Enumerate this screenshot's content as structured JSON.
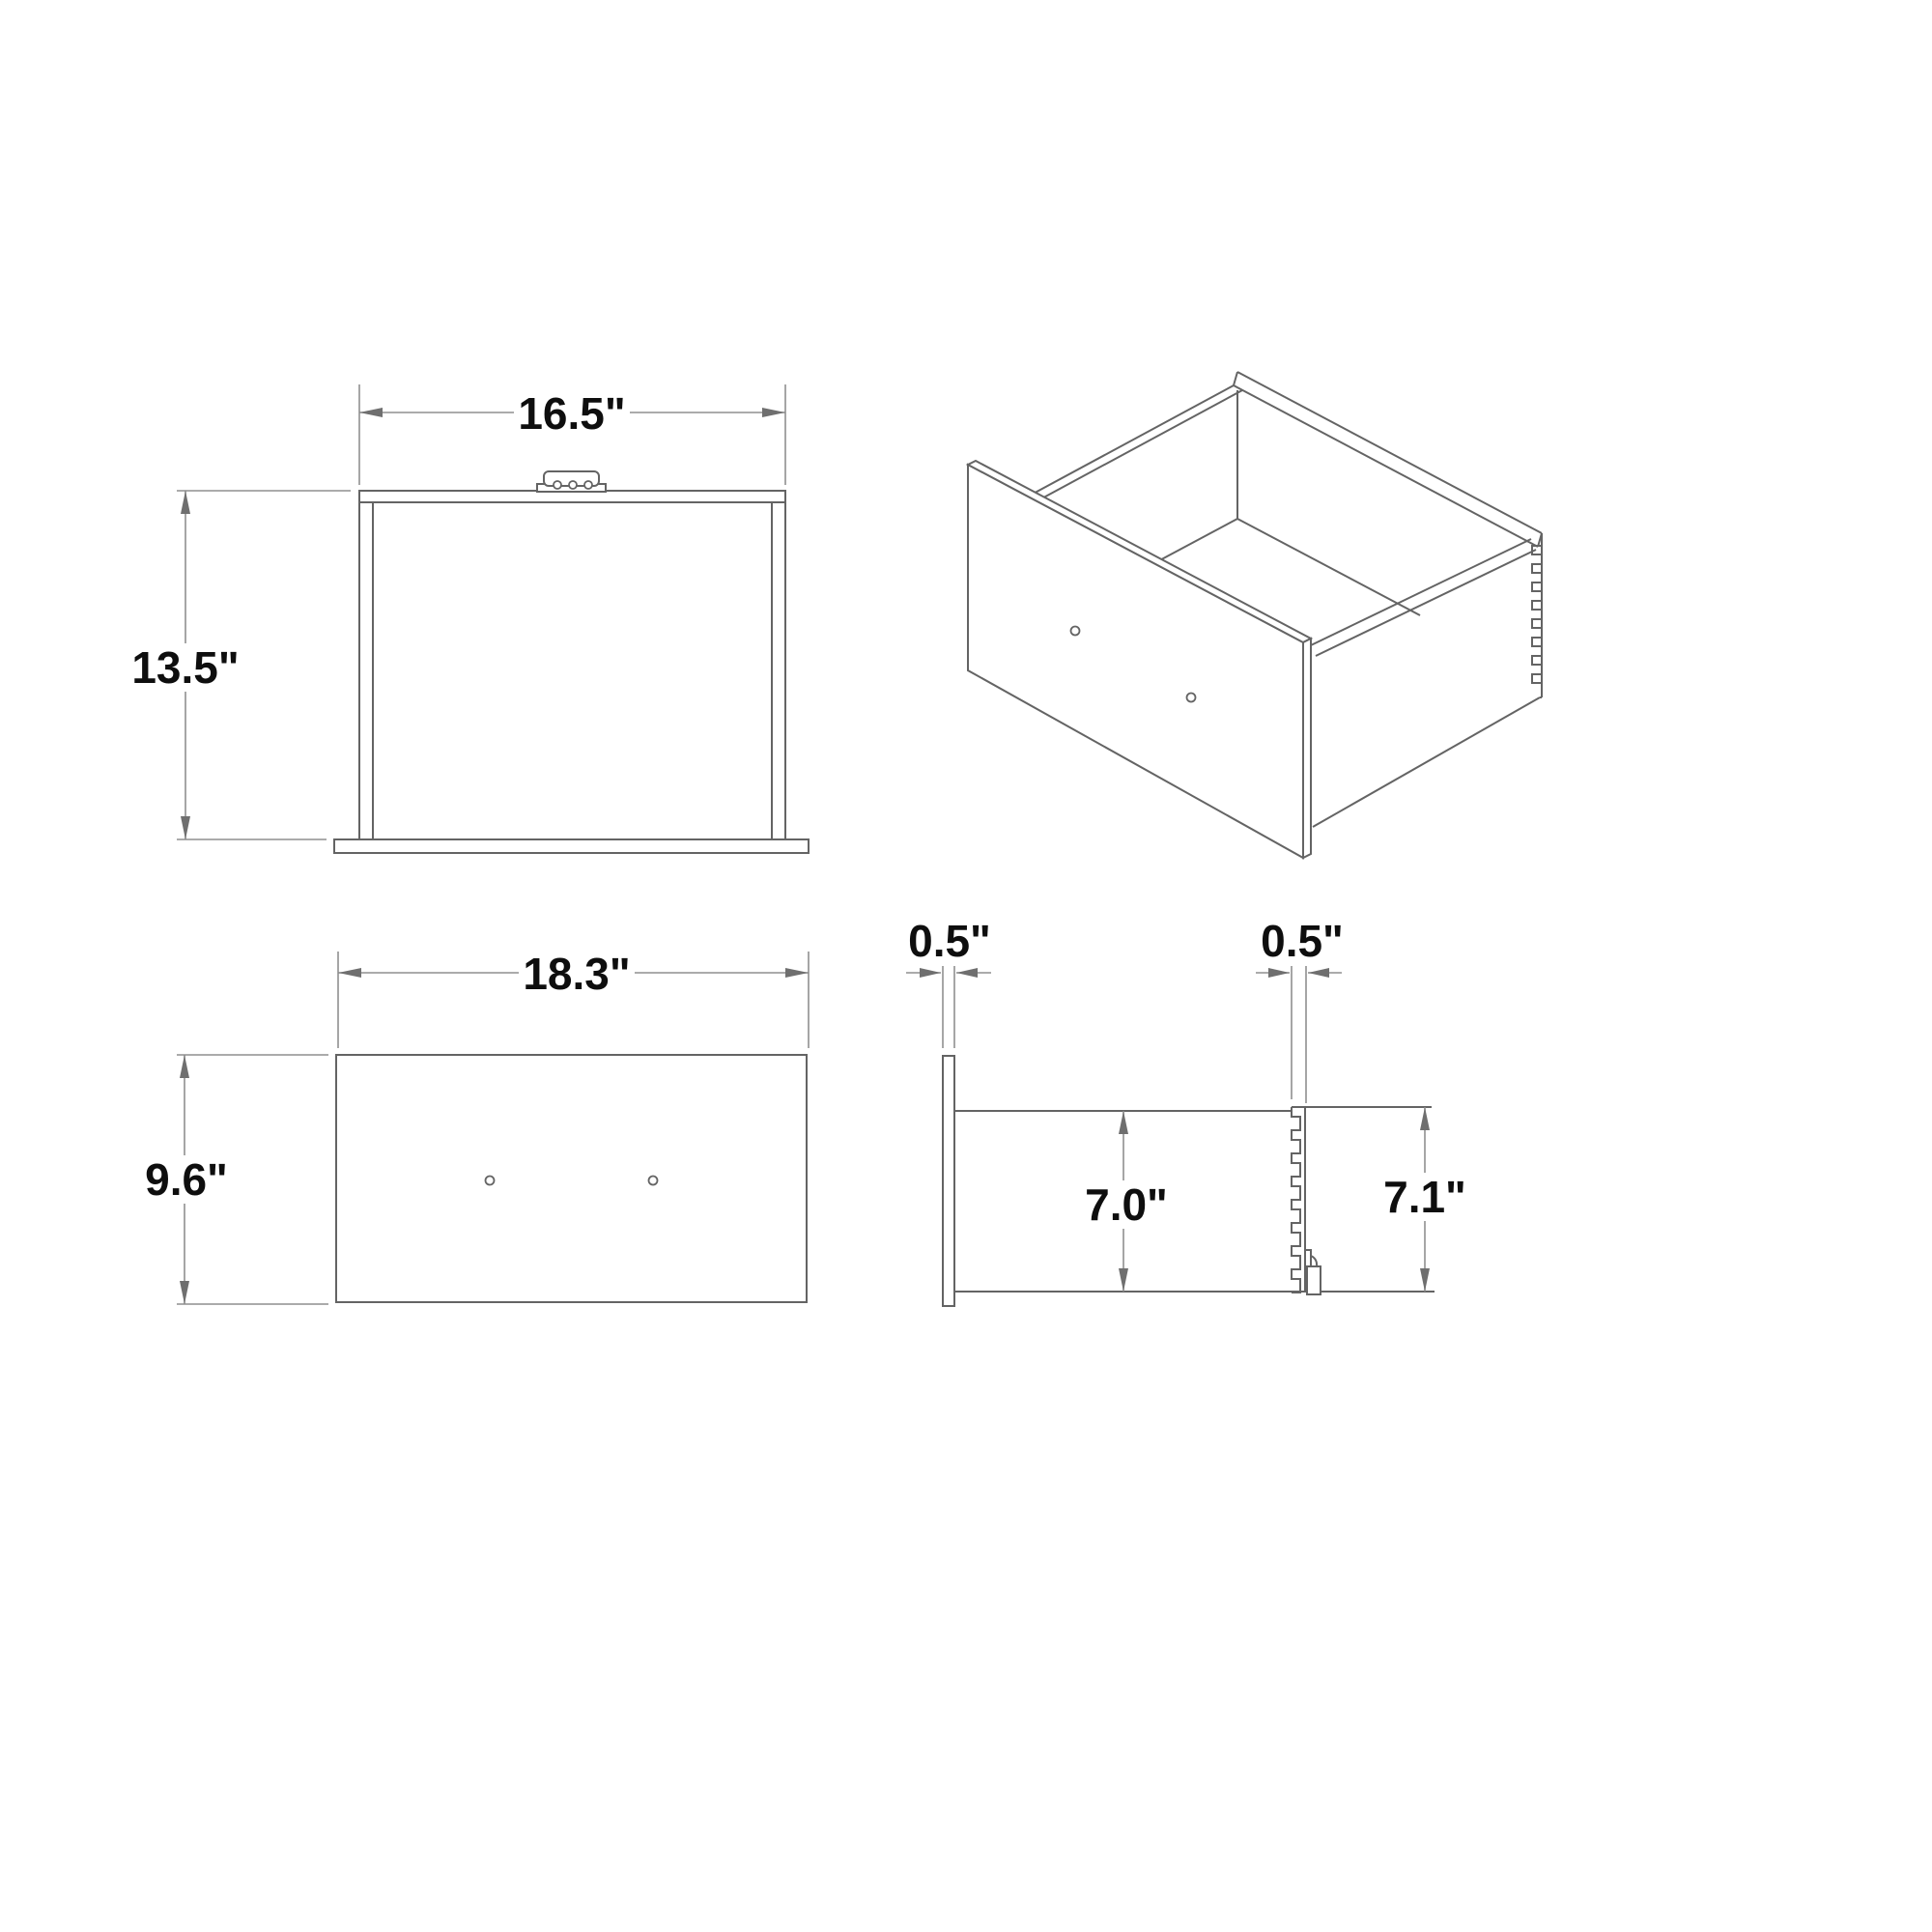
{
  "drawing": {
    "type": "drawer technical drawing",
    "units": "inches",
    "colors": {
      "background": "#ffffff",
      "part_line": "#646464",
      "dimension_line": "#8f8f8f",
      "text": "#0e0e0e"
    },
    "views": {
      "top": {
        "width_dim": "16.5\"",
        "depth_dim": "13.5\""
      },
      "isometric": {
        "features": "drawer box with dovetail joints, front panel, two handle holes"
      },
      "front_panel": {
        "width_dim": "18.3\"",
        "height_dim": "9.6\""
      },
      "side_section": {
        "front_thickness_dim": "0.5\"",
        "back_thickness_dim": "0.5\"",
        "side_height_dim": "7.0\"",
        "back_height_dim": "7.1\""
      }
    }
  }
}
